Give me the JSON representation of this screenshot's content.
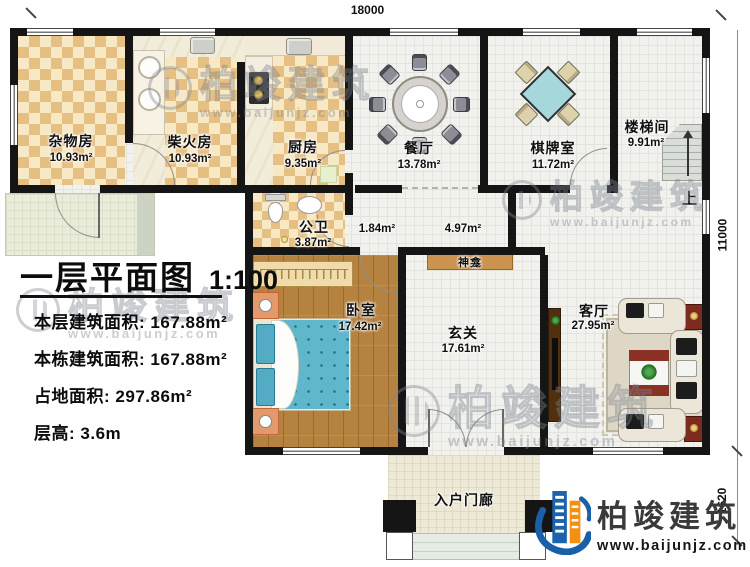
{
  "dimensions": {
    "top": "18000",
    "right": "11000",
    "bottom_right": "1620"
  },
  "title_block": {
    "title": "一层平面图",
    "scale": "1:100",
    "info": [
      {
        "label": "本层建筑面积:",
        "value": "167.88m²"
      },
      {
        "label": "本栋建筑面积:",
        "value": "167.88m²"
      },
      {
        "label": "占地面积:",
        "value": "297.86m²"
      },
      {
        "label": "层高:",
        "value": "3.6m"
      }
    ]
  },
  "rooms": [
    {
      "name": "杂物房",
      "area": "10.93m²"
    },
    {
      "name": "柴火房",
      "area": "10.93m²"
    },
    {
      "name": "厨房",
      "area": "9.35m²"
    },
    {
      "name": "餐厅",
      "area": "13.78m²"
    },
    {
      "name": "棋牌室",
      "area": "11.72m²"
    },
    {
      "name": "楼梯间",
      "area": "9.91m²"
    },
    {
      "name": "公卫",
      "area": "3.87m²"
    },
    {
      "name": "卧室",
      "area": "17.42m²"
    },
    {
      "name": "玄关",
      "area": "17.61m²"
    },
    {
      "name": "客厅",
      "area": "27.95m²"
    }
  ],
  "annotations": {
    "corridor_small_area": "1.84m²",
    "corridor_area": "4.97m²",
    "shrine": "神龛",
    "stairs_up": "上",
    "porch": "入户门廊"
  },
  "watermark": {
    "brand": "柏竣建筑",
    "url": "www.baijunjz.com"
  },
  "logo": {
    "brand": "柏竣建筑",
    "url": "www.baijunjz.com"
  },
  "colors": {
    "wall": "#151515",
    "checker_tan": "#e6bf82",
    "wood_floor": "#b5823f",
    "bed_teal": "#64b9ce",
    "accent_maroon": "#7d2b1e",
    "logo_blue": "#1960a8",
    "logo_orange": "#f29111"
  }
}
